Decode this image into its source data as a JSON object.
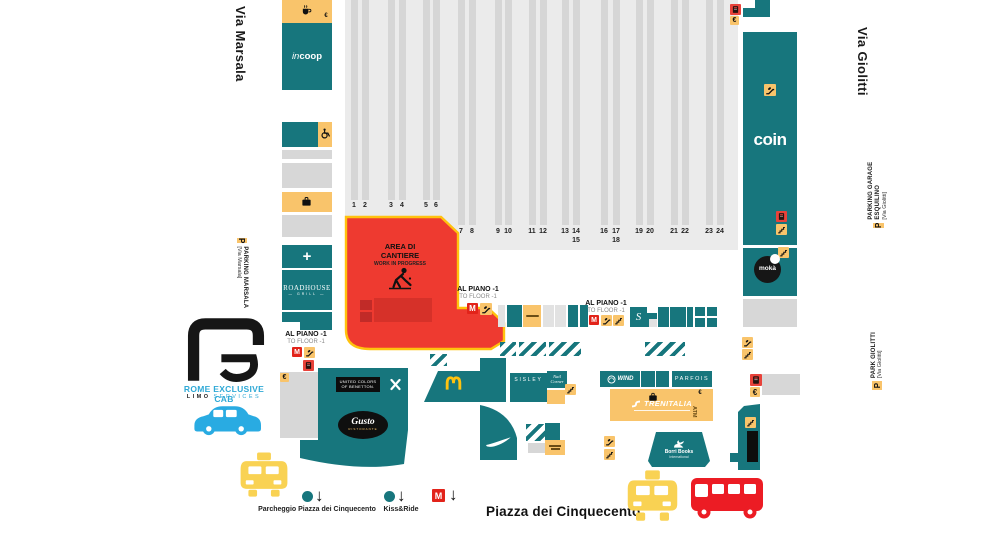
{
  "region": {
    "street_left": "Via Marsala",
    "street_right": "Via Giolitti",
    "square": "Piazza dei Cinquecento"
  },
  "parking_labels": {
    "marsala": {
      "p": "P",
      "name": "PARKING MARSALA",
      "via": "[Via Marsala]"
    },
    "esquilino": {
      "p": "P",
      "name1": "PARKING GARAGE",
      "name2": "ESQUILINO",
      "via": "[Via Giolitti]"
    },
    "giolitti": {
      "p": "P",
      "name": "PARK GIOLITTI",
      "via": "[Via Giolitti]"
    }
  },
  "construction": {
    "line1": "AREA DI",
    "line2": "CANTIERE",
    "line3": "WORK IN PROGRESS"
  },
  "floor_label": {
    "line1": "AL PIANO -1",
    "line2": "TO FLOOR -1"
  },
  "platforms": {
    "row1": [
      "1",
      "2",
      "3",
      "4",
      "5",
      "6"
    ],
    "row2": [
      "7",
      "8",
      "9",
      "10",
      "11",
      "12",
      "13",
      "14|15",
      "16",
      "17|18",
      "19",
      "20",
      "21",
      "22",
      "23",
      "24"
    ]
  },
  "shops": {
    "coop_a": "in",
    "coop_b": "coop",
    "roadhouse": "ROADHOUSE",
    "roadhouse_sub": "GRILL",
    "coin": "coin",
    "moka": "mokà",
    "benetton1": "UNITED COLORS",
    "benetton2": "OF BENETTON.",
    "gusto": "Gusto",
    "gusto_sub": "RISTORANTE",
    "sisley": "SISLEY",
    "nail1": "Nail",
    "nail2": "Corner",
    "wind": "WIND",
    "parfois": "PARFOIS",
    "trenitalia": "TRENITALIA",
    "atm": "ATM",
    "borri": "Borri Books",
    "borri_sub": "International"
  },
  "legend": {
    "parcheggio": "Parcheggio Piazza dei Cinquecento",
    "kiss_ride": "Kiss&Ride",
    "metro_m": "M"
  },
  "brand": {
    "title": "ROME EXCLUSIVE CAB",
    "sub1": "LIMO",
    "sub2": "SERVICES"
  },
  "icons_text": {
    "metro": "M",
    "parking": "P",
    "euro": "€"
  },
  "colors": {
    "teal": "#17767D",
    "orange": "#F9C46B",
    "construction_red": "#EE3A30",
    "construction_border": "#FFC20E",
    "metro_red": "#E2231A",
    "ticket_red": "#E8423A",
    "taxi_yellow": "#F9D253",
    "bus_red": "#EC1C24",
    "car_blue": "#29ABE2",
    "hall_gray": "#EBEBEB",
    "stripe_gray": "#D6D6D6"
  }
}
